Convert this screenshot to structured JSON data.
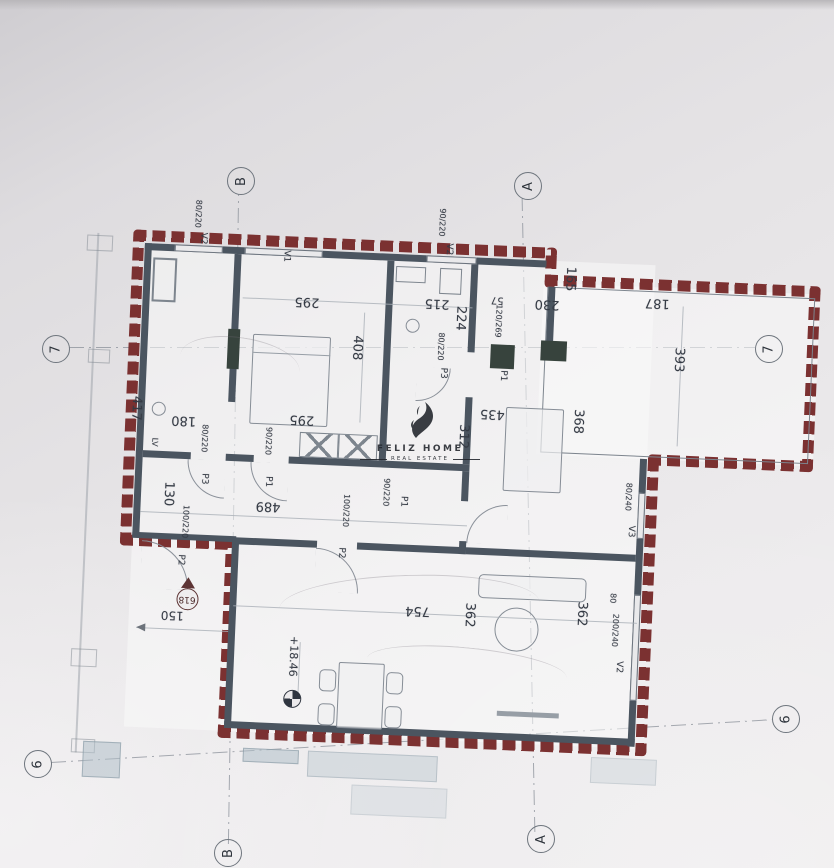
{
  "watermark": {
    "title": "FELIZ HOME",
    "subtitle": "REAL ESTATE"
  },
  "grid": {
    "bubbles": [
      {
        "id": "b-top",
        "label": "B"
      },
      {
        "id": "a-top",
        "label": "A"
      },
      {
        "id": "7-left",
        "label": "7"
      },
      {
        "id": "7-right",
        "label": "7"
      },
      {
        "id": "6-left",
        "label": "6"
      },
      {
        "id": "6-right",
        "label": "6"
      },
      {
        "id": "a-bottom",
        "label": "A"
      },
      {
        "id": "b-bottom",
        "label": "B"
      }
    ]
  },
  "plan": {
    "labels": [
      {
        "id": "dim-417",
        "text": "417"
      },
      {
        "id": "dim-180",
        "text": "180"
      },
      {
        "id": "dim-295-top",
        "text": "295"
      },
      {
        "id": "dim-295-mid",
        "text": "295"
      },
      {
        "id": "dim-408",
        "text": "408"
      },
      {
        "id": "dim-215",
        "text": "215"
      },
      {
        "id": "dim-224",
        "text": "224"
      },
      {
        "id": "dim-57",
        "text": "57"
      },
      {
        "id": "dim-230",
        "text": "230"
      },
      {
        "id": "dim-165",
        "text": "165"
      },
      {
        "id": "dim-187",
        "text": "187"
      },
      {
        "id": "dim-393",
        "text": "393"
      },
      {
        "id": "door-p1-terrace-size",
        "text": "120/269"
      },
      {
        "id": "door-p1-terrace",
        "text": "P1"
      },
      {
        "id": "win-v2a-size",
        "text": "80/220"
      },
      {
        "id": "win-v2a",
        "text": "V2"
      },
      {
        "id": "win-v1",
        "text": "V1"
      },
      {
        "id": "win-v2b-size",
        "text": "90/220"
      },
      {
        "id": "win-v2b",
        "text": "V2"
      },
      {
        "id": "door-p3-bath-size",
        "text": "80/220"
      },
      {
        "id": "door-p3-bath",
        "text": "P3"
      },
      {
        "id": "lbl-lv",
        "text": "LV"
      },
      {
        "id": "door-p3-hall-size",
        "text": "80/220"
      },
      {
        "id": "door-p3-hall",
        "text": "P3"
      },
      {
        "id": "door-p1-hall-size",
        "text": "90/220"
      },
      {
        "id": "door-p1-hall",
        "text": "P1"
      },
      {
        "id": "dim-489",
        "text": "489"
      },
      {
        "id": "dim-130",
        "text": "130"
      },
      {
        "id": "door-p1-living-size",
        "text": "90/220"
      },
      {
        "id": "door-p1-living",
        "text": "P1"
      },
      {
        "id": "door-p2-living-size",
        "text": "100/220"
      },
      {
        "id": "door-p2-living",
        "text": "P2"
      },
      {
        "id": "door-p2-entry-size",
        "text": "100/220"
      },
      {
        "id": "door-p2-entry",
        "text": "P2"
      },
      {
        "id": "dim-435",
        "text": "435"
      },
      {
        "id": "dim-312",
        "text": "312"
      },
      {
        "id": "dim-368",
        "text": "368"
      },
      {
        "id": "dim-754",
        "text": "754"
      },
      {
        "id": "dim-362-left",
        "text": "362"
      },
      {
        "id": "dim-362-right",
        "text": "362"
      },
      {
        "id": "dim-80",
        "text": "80"
      },
      {
        "id": "win-v2c-size",
        "text": "200/240"
      },
      {
        "id": "win-v2c",
        "text": "V2"
      },
      {
        "id": "win-v3-size",
        "text": "80/240"
      },
      {
        "id": "win-v3",
        "text": "V3"
      },
      {
        "id": "level-value",
        "text": "+18.46"
      },
      {
        "id": "marker-618",
        "text": "618"
      },
      {
        "id": "dim-150",
        "text": "150"
      }
    ]
  },
  "colors": {
    "brick": "#7b3131",
    "wall": "#4b5560",
    "paper": "#e4e2e4",
    "ink": "#353b45",
    "accent_blue": "#b0c0c9"
  }
}
